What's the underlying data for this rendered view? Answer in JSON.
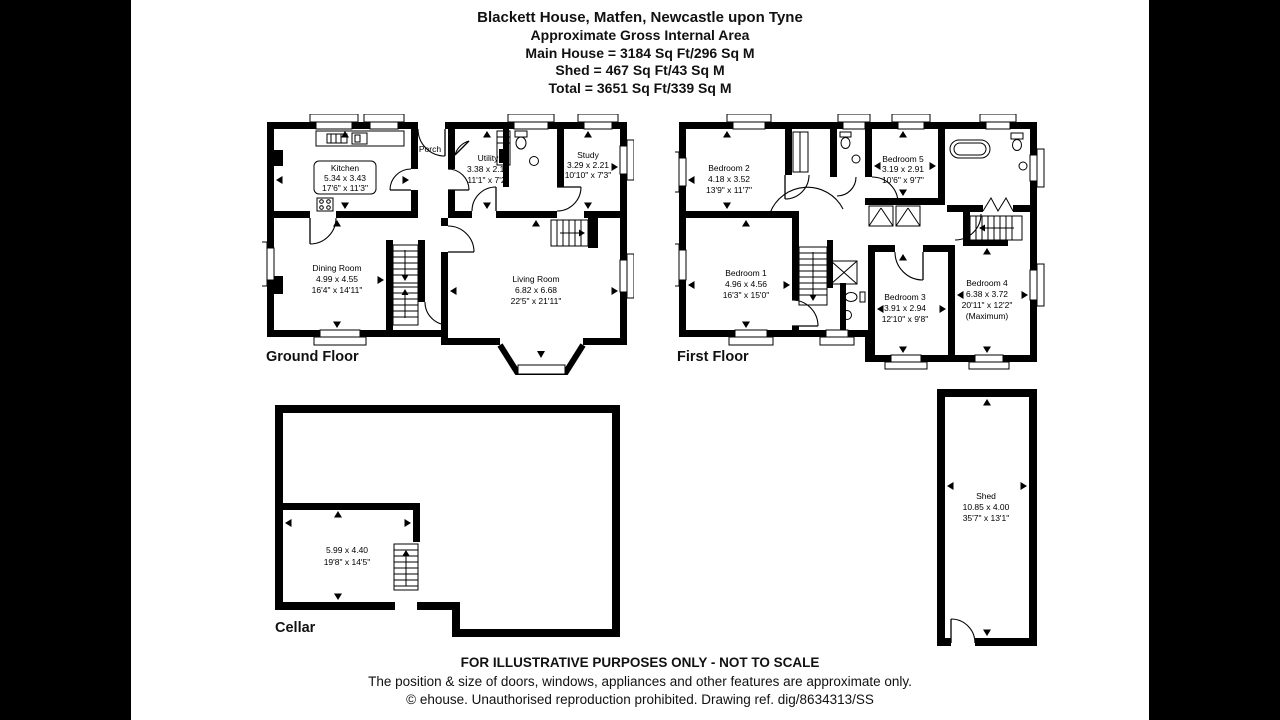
{
  "header": {
    "title": "Blackett House, Matfen, Newcastle upon Tyne",
    "subtitle": "Approximate Gross Internal Area",
    "area_main": "Main House = 3184 Sq Ft/296 Sq M",
    "area_shed": "Shed = 467 Sq Ft/43 Sq M",
    "area_total": "Total = 3651 Sq Ft/339 Sq M"
  },
  "plans": {
    "ground": {
      "label": "Ground Floor",
      "rooms": {
        "kitchen": {
          "name": "Kitchen",
          "metric": "5.34 x 3.43",
          "imperial": "17'6\" x 11'3\""
        },
        "porch": {
          "name": "Porch"
        },
        "utility": {
          "name": "Utility",
          "metric": "3.38 x 2.19",
          "imperial": "11'1\" x 7'2\""
        },
        "study": {
          "name": "Study",
          "metric": "3.29 x 2.21",
          "imperial": "10'10\" x 7'3\""
        },
        "dining": {
          "name": "Dining Room",
          "metric": "4.99 x 4.55",
          "imperial": "16'4\" x 14'11\""
        },
        "living": {
          "name": "Living Room",
          "metric": "6.82 x 6.68",
          "imperial": "22'5\" x 21'11\""
        }
      }
    },
    "first": {
      "label": "First Floor",
      "rooms": {
        "bedroom2": {
          "name": "Bedroom 2",
          "metric": "4.18 x 3.52",
          "imperial": "13'9\" x 11'7\""
        },
        "bedroom5": {
          "name": "Bedroom 5",
          "metric": "3.19 x 2.91",
          "imperial": "10'6\" x 9'7\""
        },
        "bedroom1": {
          "name": "Bedroom 1",
          "metric": "4.96 x 4.56",
          "imperial": "16'3\" x 15'0\""
        },
        "bedroom3": {
          "name": "Bedroom 3",
          "metric": "3.91 x 2.94",
          "imperial": "12'10\" x 9'8\""
        },
        "bedroom4": {
          "name": "Bedroom 4",
          "metric": "6.38 x 3.72",
          "imperial": "20'11\" x 12'2\"",
          "note": "(Maximum)"
        }
      }
    },
    "cellar": {
      "label": "Cellar",
      "rooms": {
        "cellar_room": {
          "metric": "5.99 x 4.40",
          "imperial": "19'8\" x 14'5\""
        }
      }
    },
    "shed": {
      "rooms": {
        "shed": {
          "name": "Shed",
          "metric": "10.85 x 4.00",
          "imperial": "35'7\" x 13'1\""
        }
      }
    }
  },
  "footer": {
    "line1": "FOR ILLUSTRATIVE PURPOSES ONLY - NOT TO SCALE",
    "line2": "The position & size of doors, windows, appliances and other features are approximate only.",
    "line3": "© ehouse. Unauthorised reproduction prohibited. Drawing ref. dig/8634313/SS"
  }
}
